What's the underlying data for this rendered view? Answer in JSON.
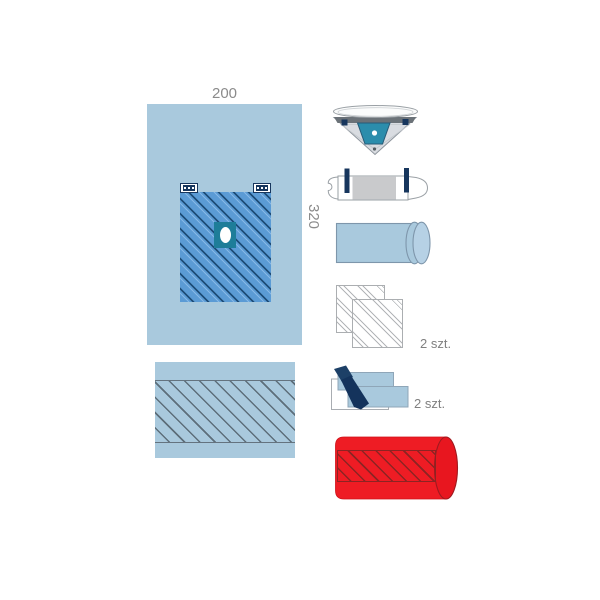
{
  "main_drape": {
    "width_label": "200",
    "height_label": "320"
  },
  "kit_items": [
    {
      "id": "fenestrated-main-drape"
    },
    {
      "id": "bottom-towel"
    },
    {
      "id": "triangular-drape"
    },
    {
      "id": "equipment-cover"
    },
    {
      "id": "drape-roll"
    },
    {
      "id": "gauze-squares",
      "qty_label": "2 szt."
    },
    {
      "id": "adhesive-towels",
      "qty_label": "2 szt."
    },
    {
      "id": "red-bandage-roll"
    }
  ],
  "colors": {
    "drape_blue": "#a9c9dd",
    "field_blue": "#5b9bd5",
    "field_hatch_navy": "#1e4d78",
    "teal": "#1e7d99",
    "navy": "#17365d",
    "red": "#ee1c24",
    "dark_red": "#8c2423",
    "label_gray": "#8b8b8b"
  }
}
